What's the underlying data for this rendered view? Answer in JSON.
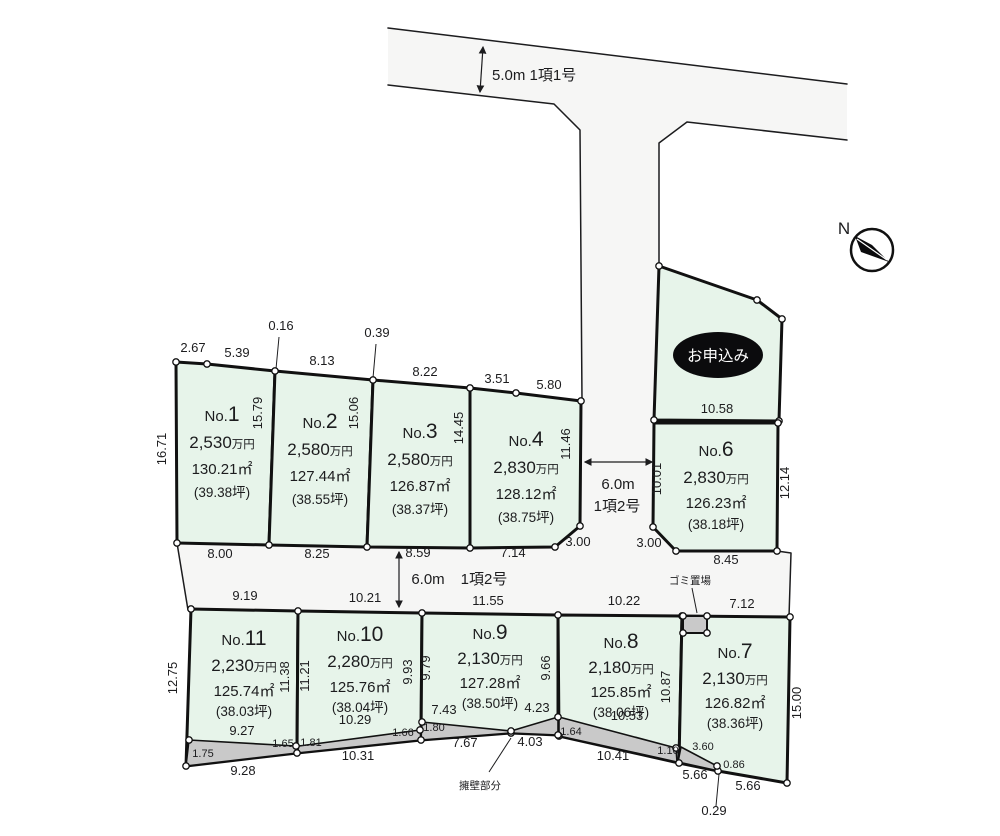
{
  "compass": {
    "label": "N"
  },
  "roads": {
    "top": {
      "label": "5.0m 1項1号"
    },
    "vertical": {
      "width_label": "6.0m",
      "type_label": "1項2号"
    },
    "middle": {
      "width_label": "6.0m",
      "type_label": "1項2号"
    }
  },
  "annotations": {
    "garbage": "ゴミ置場",
    "wall": "擁壁部分"
  },
  "plots": [
    {
      "id": "1",
      "no_prefix": "No.",
      "no_digit": "1",
      "price_num": "2,530",
      "price_unit": "万円",
      "area": "130.21㎡",
      "tsubo": "(39.38坪)"
    },
    {
      "id": "2",
      "no_prefix": "No.",
      "no_digit": "2",
      "price_num": "2,580",
      "price_unit": "万円",
      "area": "127.44㎡",
      "tsubo": "(38.55坪)"
    },
    {
      "id": "3",
      "no_prefix": "No.",
      "no_digit": "3",
      "price_num": "2,580",
      "price_unit": "万円",
      "area": "126.87㎡",
      "tsubo": "(38.37坪)"
    },
    {
      "id": "4",
      "no_prefix": "No.",
      "no_digit": "4",
      "price_num": "2,830",
      "price_unit": "万円",
      "area": "128.12㎡",
      "tsubo": "(38.75坪)"
    },
    {
      "id": "5",
      "status": "お申込み"
    },
    {
      "id": "6",
      "no_prefix": "No.",
      "no_digit": "6",
      "price_num": "2,830",
      "price_unit": "万円",
      "area": "126.23㎡",
      "tsubo": "(38.18坪)"
    },
    {
      "id": "7",
      "no_prefix": "No.",
      "no_digit": "7",
      "price_num": "2,130",
      "price_unit": "万円",
      "area": "126.82㎡",
      "tsubo": "(38.36坪)"
    },
    {
      "id": "8",
      "no_prefix": "No.",
      "no_digit": "8",
      "price_num": "2,180",
      "price_unit": "万円",
      "area": "125.85㎡",
      "tsubo": "(38.06坪)"
    },
    {
      "id": "9",
      "no_prefix": "No.",
      "no_digit": "9",
      "price_num": "2,130",
      "price_unit": "万円",
      "area": "127.28㎡",
      "tsubo": "(38.50坪)"
    },
    {
      "id": "10",
      "no_prefix": "No.",
      "no_digit": "10",
      "price_num": "2,280",
      "price_unit": "万円",
      "area": "125.76㎡",
      "tsubo": "(38.04坪)"
    },
    {
      "id": "11",
      "no_prefix": "No.",
      "no_digit": "11",
      "price_num": "2,230",
      "price_unit": "万円",
      "area": "125.74㎡",
      "tsubo": "(38.03坪)"
    }
  ],
  "dims": [
    {
      "t": "2.67",
      "x": 193,
      "y": 352
    },
    {
      "t": "5.39",
      "x": 237,
      "y": 357
    },
    {
      "t": "0.16",
      "x": 281,
      "y": 330
    },
    {
      "t": "8.13",
      "x": 322,
      "y": 365
    },
    {
      "t": "0.39",
      "x": 377,
      "y": 337
    },
    {
      "t": "8.22",
      "x": 425,
      "y": 376
    },
    {
      "t": "3.51",
      "x": 497,
      "y": 383
    },
    {
      "t": "5.80",
      "x": 549,
      "y": 389
    },
    {
      "t": "16.71",
      "x": 166,
      "y": 449,
      "rot": true
    },
    {
      "t": "15.79",
      "x": 262,
      "y": 413,
      "rot": true
    },
    {
      "t": "15.06",
      "x": 358,
      "y": 413,
      "rot": true
    },
    {
      "t": "14.45",
      "x": 463,
      "y": 428,
      "rot": true
    },
    {
      "t": "11.46",
      "x": 570,
      "y": 444,
      "rot": true
    },
    {
      "t": "8.00",
      "x": 220,
      "y": 558
    },
    {
      "t": "8.25",
      "x": 317,
      "y": 558
    },
    {
      "t": "8.59",
      "x": 418,
      "y": 557
    },
    {
      "t": "7.14",
      "x": 513,
      "y": 557
    },
    {
      "t": "3.00",
      "x": 578,
      "y": 546
    },
    {
      "t": "3.00",
      "x": 649,
      "y": 547
    },
    {
      "t": "10.58",
      "x": 717,
      "y": 413
    },
    {
      "t": "10.01",
      "x": 661,
      "y": 479,
      "rot": true
    },
    {
      "t": "12.14",
      "x": 789,
      "y": 483,
      "rot": true
    },
    {
      "t": "8.45",
      "x": 726,
      "y": 564
    },
    {
      "t": "9.19",
      "x": 245,
      "y": 600
    },
    {
      "t": "10.21",
      "x": 365,
      "y": 602
    },
    {
      "t": "11.55",
      "x": 488,
      "y": 605
    },
    {
      "t": "10.22",
      "x": 624,
      "y": 605
    },
    {
      "t": "7.12",
      "x": 742,
      "y": 608
    },
    {
      "t": "12.75",
      "x": 177,
      "y": 678,
      "rot": true
    },
    {
      "t": "11.38",
      "x": 289,
      "y": 677,
      "rot": true
    },
    {
      "t": "11.21",
      "x": 309,
      "y": 676,
      "rot": true
    },
    {
      "t": "9.93",
      "x": 412,
      "y": 672,
      "rot": true
    },
    {
      "t": "9.79",
      "x": 430,
      "y": 668,
      "rot": true
    },
    {
      "t": "9.66",
      "x": 550,
      "y": 668,
      "rot": true
    },
    {
      "t": "10.87",
      "x": 670,
      "y": 687,
      "rot": true
    },
    {
      "t": "15.00",
      "x": 801,
      "y": 703,
      "rot": true
    },
    {
      "t": "9.27",
      "x": 242,
      "y": 735
    },
    {
      "t": "1.75",
      "x": 203,
      "y": 757,
      "small": true
    },
    {
      "t": "1.65",
      "x": 283,
      "y": 747,
      "small": true
    },
    {
      "t": "9.28",
      "x": 243,
      "y": 775
    },
    {
      "t": "10.29",
      "x": 355,
      "y": 724
    },
    {
      "t": "1.81",
      "x": 311,
      "y": 746,
      "small": true
    },
    {
      "t": "1.66",
      "x": 403,
      "y": 736,
      "small": true
    },
    {
      "t": "10.31",
      "x": 358,
      "y": 760
    },
    {
      "t": "7.43",
      "x": 444,
      "y": 714
    },
    {
      "t": "4.23",
      "x": 537,
      "y": 712
    },
    {
      "t": "1.80",
      "x": 434,
      "y": 731,
      "small": true
    },
    {
      "t": "7.67",
      "x": 465,
      "y": 747
    },
    {
      "t": "4.03",
      "x": 530,
      "y": 746
    },
    {
      "t": "10.53",
      "x": 627,
      "y": 720
    },
    {
      "t": "1.64",
      "x": 571,
      "y": 735,
      "small": true
    },
    {
      "t": "10.41",
      "x": 613,
      "y": 760
    },
    {
      "t": "1.10",
      "x": 668,
      "y": 754,
      "small": true
    },
    {
      "t": "3.60",
      "x": 703,
      "y": 750,
      "small": true
    },
    {
      "t": "0.86",
      "x": 734,
      "y": 768,
      "small": true
    },
    {
      "t": "5.66",
      "x": 695,
      "y": 779
    },
    {
      "t": "5.66",
      "x": 748,
      "y": 790
    },
    {
      "t": "0.29",
      "x": 714,
      "y": 815
    }
  ]
}
